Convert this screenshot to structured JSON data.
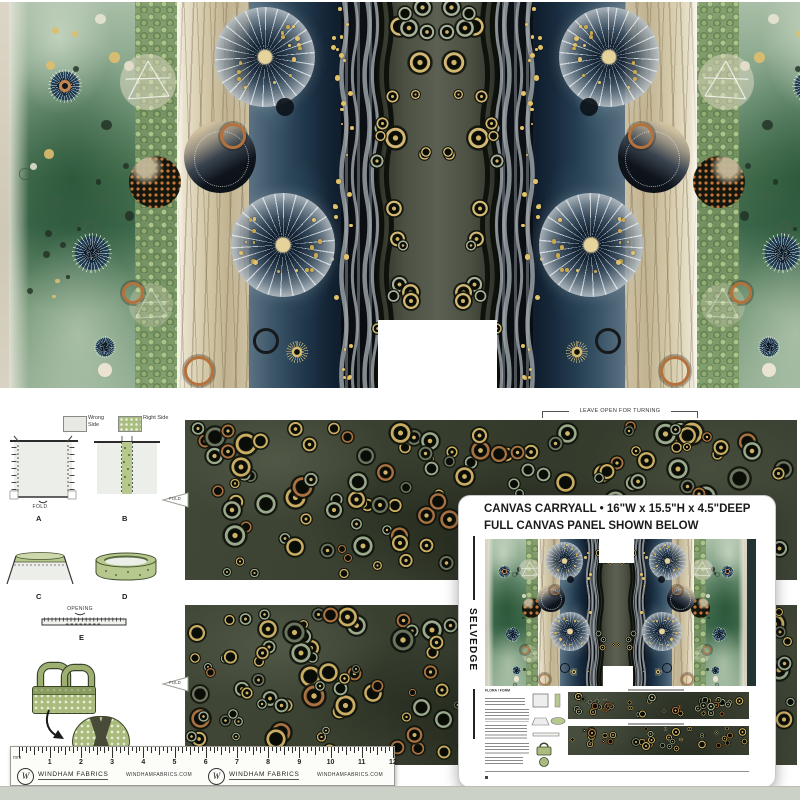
{
  "product": {
    "title": "CANVAS CARRYALL • 16\"W x 15.5\"H x 4.5\"DEEP",
    "subtitle": "FULL CANVAS PANEL SHOWN BELOW",
    "selvedge_label": "SELVEDGE",
    "mini_sheet_title": "FLORA / FORM"
  },
  "instructions": {
    "leave_open_label": "LEAVE OPEN FOR TURNING",
    "fold_label": "FOLD",
    "opening_label": "OPENING",
    "legend": {
      "wrong_side": "Wrong Side",
      "right_side": "Right Side"
    },
    "steps": [
      "A",
      "B",
      "C",
      "D",
      "E"
    ]
  },
  "ruler": {
    "unit_label": "mm",
    "numbers": [
      "1",
      "2",
      "3",
      "4",
      "5",
      "6",
      "7",
      "8",
      "9",
      "10",
      "11",
      "12"
    ],
    "brand": "WINDHAM FABRICS",
    "website": "WINDHAMFABRICS.COM",
    "monogram": "W"
  },
  "palette": {
    "green_band": "#55795d",
    "pebble_band": "#7d9a6f",
    "tan_band": "#cfc3a0",
    "blue_band": "#2b4256",
    "navy_band": "#0c1016",
    "center_band": "#4c5042",
    "strip_base": "#3e4438",
    "gold": "#d3b873",
    "rust": "#b4713c",
    "card_bg": "#ffffff",
    "bottom_band": "#cbd1c7"
  }
}
